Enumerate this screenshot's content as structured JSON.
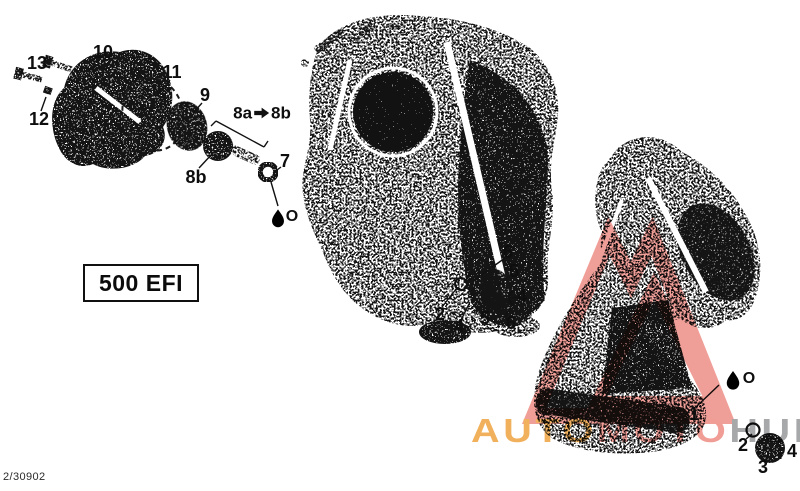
{
  "diagram": {
    "model_label": "500 EFI",
    "document_code": "2/30902",
    "oil_symbol": "O",
    "sequence_note": {
      "from": "8a",
      "arrow": "→",
      "to": "8b"
    },
    "callouts": [
      {
        "id": "13",
        "text": "13"
      },
      {
        "id": "10",
        "text": "10"
      },
      {
        "id": "12",
        "text": "12"
      },
      {
        "id": "11",
        "text": "11"
      },
      {
        "id": "9",
        "text": "9"
      },
      {
        "id": "8b",
        "text": "8b"
      },
      {
        "id": "7",
        "text": "7"
      },
      {
        "id": "6-mid-top",
        "text": "6"
      },
      {
        "id": "5-mid-top",
        "text": "5"
      },
      {
        "id": "4-mid-top",
        "text": "4"
      },
      {
        "id": "2-mid",
        "text": "2"
      },
      {
        "id": "4-mid-bottom",
        "text": "4"
      },
      {
        "id": "5-mid-bottom",
        "text": "5"
      },
      {
        "id": "6-mid-bottom",
        "text": "6"
      },
      {
        "id": "1",
        "text": "1"
      },
      {
        "id": "2-right",
        "text": "2"
      },
      {
        "id": "3-right",
        "text": "3"
      },
      {
        "id": "4-right",
        "text": "4"
      }
    ]
  },
  "watermark": {
    "logo_color": "#ED8C84",
    "text_parts": [
      {
        "text": "AUTO",
        "color": "#EFA13B"
      },
      {
        "text": "MOTO",
        "color": "#ED8A82"
      },
      {
        "text": "HUB",
        "color": "#96979A"
      }
    ]
  }
}
